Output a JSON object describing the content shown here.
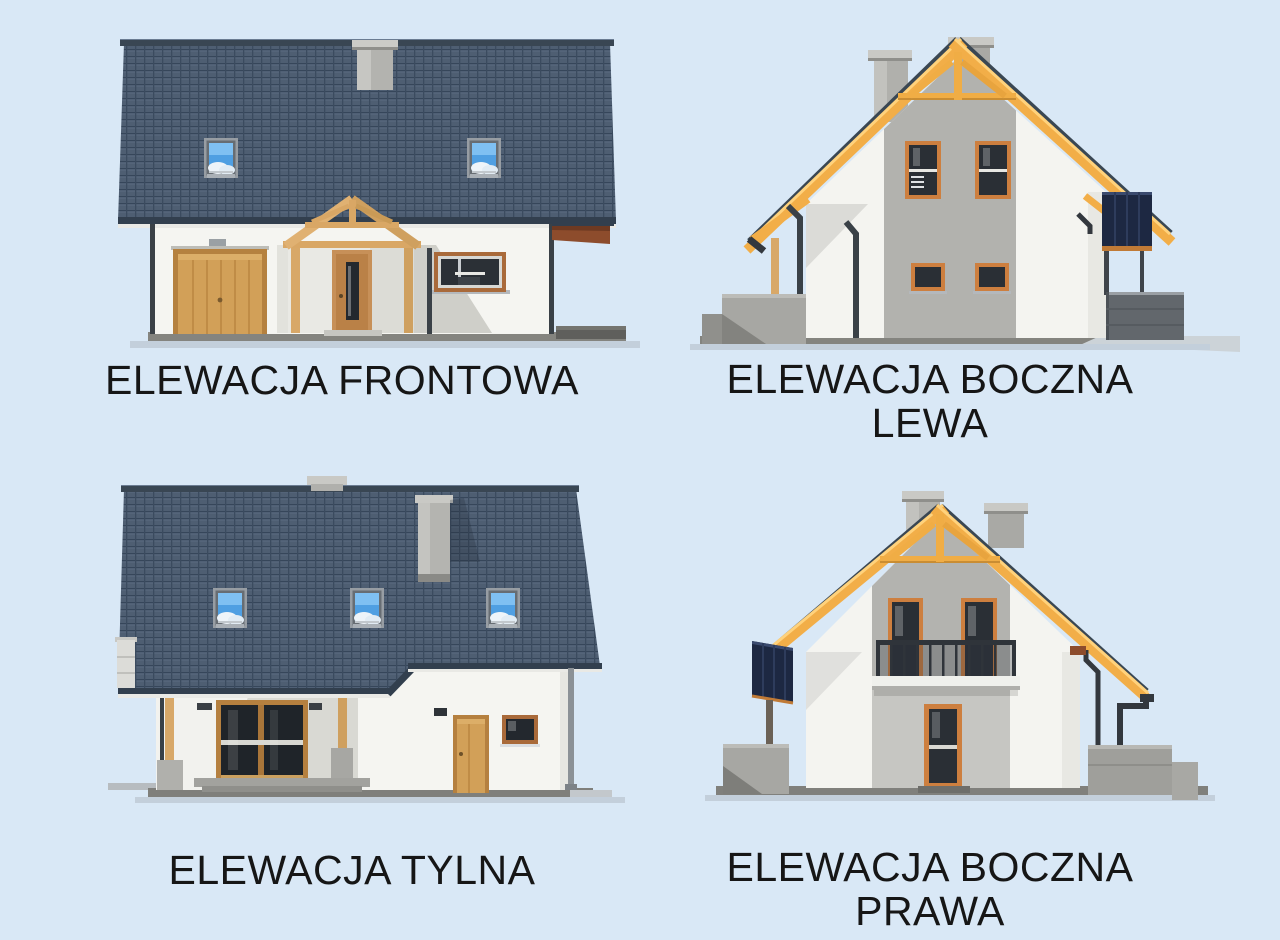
{
  "palette": {
    "background": "#d9e8f6",
    "roof_tile": "#4e5e72",
    "roof_tile_dark": "#36465a",
    "roof_fascia": "#323f4e",
    "timber_yellow": "#f2ae48",
    "timber_tan": "#d8a868",
    "garage_wood": "#d2a058",
    "window_frame_orange": "#cd7f3f",
    "window_frame_brown": "#a96a3a",
    "glass_dark": "#272c33",
    "skylight_blue": "#4f9fe2",
    "wall_white": "#f4f4f1",
    "wall_gray": "#b2b2ae",
    "concrete_gray": "#a7a7a3",
    "ground_gray": "#82827e",
    "solar_panel_navy": "#1d2842",
    "label_text": "#161616"
  },
  "elevations": {
    "front": {
      "label": "ELEWACJA FRONTOWA"
    },
    "side_left": {
      "label_line1": "ELEWACJA BOCZNA",
      "label_line2": "LEWA"
    },
    "rear": {
      "label": "ELEWACJA TYLNA"
    },
    "side_right": {
      "label_line1": "ELEWACJA BOCZNA",
      "label_line2": "PRAWA"
    }
  }
}
